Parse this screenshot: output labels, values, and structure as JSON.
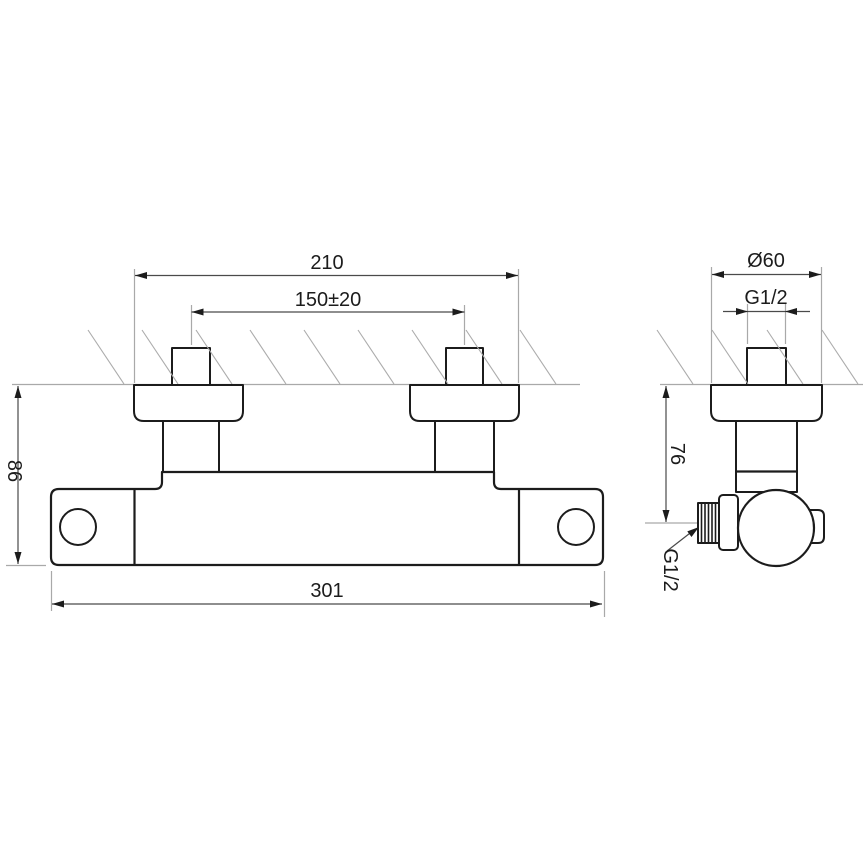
{
  "drawing": {
    "type": "technical-dimension-drawing",
    "subject": "wall-mounted shower mixer tap, front view and side view",
    "colors": {
      "outline": "#1c1c1c",
      "dimension_line": "#4a4a4a",
      "extension_line": "#a9a9a9",
      "background": "#ffffff"
    }
  },
  "labels": {
    "front": {
      "mount_outer_width": "210",
      "connection_spacing": "150±20",
      "body_height": "86",
      "body_length": "301"
    },
    "side": {
      "escutcheon_diameter": "Ø60",
      "inlet_thread": "G1/2",
      "outlet_depth": "76",
      "outlet_thread": "G1/2"
    }
  }
}
